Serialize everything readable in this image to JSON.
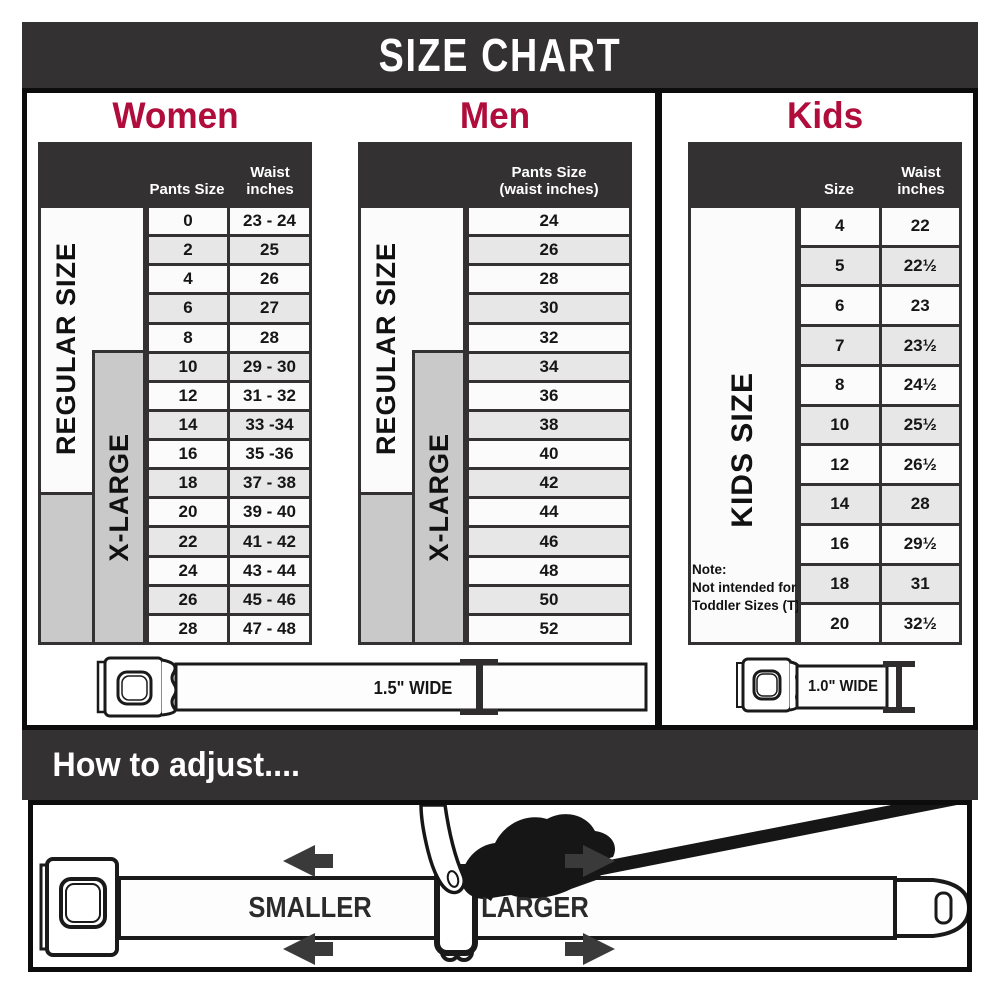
{
  "title": "SIZE CHART",
  "colors": {
    "accent": "#b00c3c",
    "dark": "#333132",
    "row_light": "#fbfbfb",
    "row_shaded": "#e7e7e7",
    "panel_gray": "#c9c9c9"
  },
  "sections": {
    "women": {
      "heading": "Women",
      "col1_header": "Pants Size",
      "waist_l1": "Waist",
      "waist_l2": "inches",
      "regular_label": "REGULAR SIZE",
      "xlarge_label": "X-LARGE",
      "rows": [
        [
          "0",
          "23 - 24"
        ],
        [
          "2",
          "25"
        ],
        [
          "4",
          "26"
        ],
        [
          "6",
          "27"
        ],
        [
          "8",
          "28"
        ],
        [
          "10",
          "29 - 30"
        ],
        [
          "12",
          "31 - 32"
        ],
        [
          "14",
          "33 -34"
        ],
        [
          "16",
          "35 -36"
        ],
        [
          "18",
          "37 - 38"
        ],
        [
          "20",
          "39 - 40"
        ],
        [
          "22",
          "41 - 42"
        ],
        [
          "24",
          "43 - 44"
        ],
        [
          "26",
          "45 - 46"
        ],
        [
          "28",
          "47 - 48"
        ]
      ],
      "belt_label": "1.5\" WIDE"
    },
    "men": {
      "heading": "Men",
      "head_l1": "Pants Size",
      "head_l2": "(waist inches)",
      "regular_label": "REGULAR SIZE",
      "xlarge_label": "X-LARGE",
      "rows": [
        "24",
        "26",
        "28",
        "30",
        "32",
        "34",
        "36",
        "38",
        "40",
        "42",
        "44",
        "46",
        "48",
        "50",
        "52"
      ]
    },
    "kids": {
      "heading": "Kids",
      "col1_header": "Size",
      "waist_l1": "Waist",
      "waist_l2": "inches",
      "side_label": "KIDS SIZE",
      "note_l1": "Note:",
      "note_l2": "Not intended for",
      "note_l3": "Toddler Sizes (T)",
      "rows": [
        [
          "4",
          "22"
        ],
        [
          "5",
          "22½"
        ],
        [
          "6",
          "23"
        ],
        [
          "7",
          "23½"
        ],
        [
          "8",
          "24½"
        ],
        [
          "10",
          "25½"
        ],
        [
          "12",
          "26½"
        ],
        [
          "14",
          "28"
        ],
        [
          "16",
          "29½"
        ],
        [
          "18",
          "31"
        ],
        [
          "20",
          "32½"
        ]
      ],
      "belt_label": "1.0\" WIDE"
    }
  },
  "how_to": {
    "heading": "How to adjust....",
    "smaller": "SMALLER",
    "larger": "LARGER"
  }
}
